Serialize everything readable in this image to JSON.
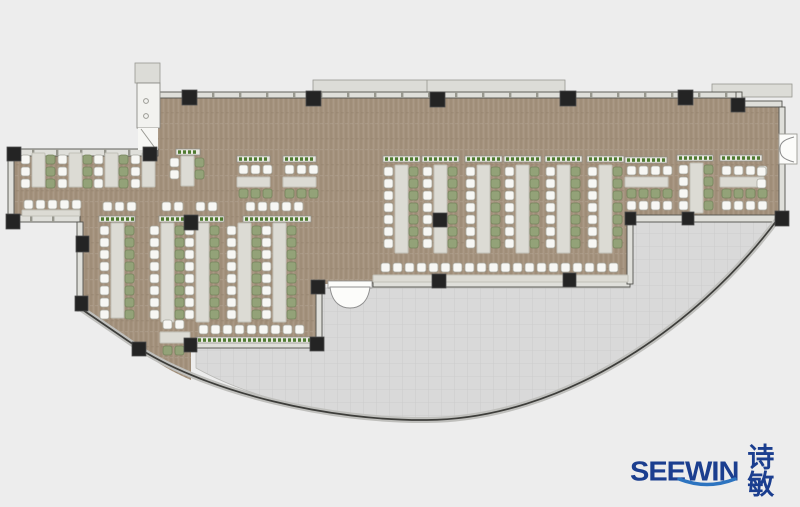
{
  "canvas": {
    "w": 800,
    "h": 507,
    "bg": "#ededed"
  },
  "colors": {
    "floor_wood": "#a5937e",
    "floor_tile": "#d9d9d9",
    "tile_line": "#c9c9c9",
    "wall_fill": "#dfdfda",
    "wall_line": "#52524d",
    "ledge_fill": "#dcdcd7",
    "ledge_line": "#97978f",
    "facade_band": "#bfbfbc",
    "facade_line": "#3d3d3a",
    "column": "#242424",
    "desk_fill": "#dcdbd4",
    "desk_line": "#c2c1b8",
    "chair_white": "#f7f7f4",
    "chair_white_line": "#a8a89e",
    "chair_green": "#93a278",
    "chair_green_line": "#75845c",
    "planter_fill": "#e9e8e1",
    "planter_line": "#8e8e86",
    "planter_green": "#4e7a30",
    "door_fill": "#fcfcfa",
    "door_line": "#8e8e8e",
    "logo_navy": "#1b3e8f",
    "logo_smile": "#2d74c0"
  },
  "logo": {
    "brand": "SEEWIN",
    "cn": "诗敏"
  },
  "floors": {
    "brown": "M158,92 L740,92 L740,104 L782,104 L782,215 L630,215 L630,284 L322,284 L322,345 L191,345 L191,380 C163,368 148,356 140,349 L80,308 L80,222 L11,222 L11,152 L158,152 Z",
    "gray": "M196,348 L322,348 L322,288 L630,288 L630,222 L773,222 C688,332 560,418 427,419 C333,419 252,399 196,368 Z"
  },
  "facade": {
    "path": "M80,308 L140,349 C210,393 330,421 427,420 C560,419 695,330 777,220"
  },
  "ledges": [
    {
      "x": 313,
      "y": 80,
      "w": 252,
      "h": 13,
      "div": 427
    },
    {
      "x": 712,
      "y": 84,
      "w": 80,
      "h": 13
    },
    {
      "x": 135,
      "y": 63,
      "w": 25,
      "h": 20
    }
  ],
  "walls": [
    {
      "x": 158,
      "y": 92,
      "w": 582,
      "h": 6,
      "ticks": 27
    },
    {
      "x": 736,
      "y": 92,
      "w": 6,
      "h": 12
    },
    {
      "x": 736,
      "y": 101,
      "w": 46,
      "h": 6
    },
    {
      "x": 779,
      "y": 107,
      "w": 6,
      "h": 29
    },
    {
      "x": 779,
      "y": 163,
      "w": 6,
      "h": 52
    },
    {
      "x": 8,
      "y": 149,
      "w": 150,
      "h": 7,
      "ticks": 24
    },
    {
      "x": 8,
      "y": 149,
      "w": 6,
      "h": 72
    },
    {
      "x": 8,
      "y": 215,
      "w": 72,
      "h": 7,
      "ticks": 22
    },
    {
      "x": 77,
      "y": 222,
      "w": 6,
      "h": 89
    },
    {
      "x": 188,
      "y": 342,
      "w": 134,
      "h": 6
    },
    {
      "x": 316,
      "y": 286,
      "w": 6,
      "h": 60
    },
    {
      "x": 373,
      "y": 281,
      "w": 257,
      "h": 6
    },
    {
      "x": 627,
      "y": 222,
      "w": 6,
      "h": 62
    },
    {
      "x": 627,
      "y": 215,
      "w": 154,
      "h": 7
    }
  ],
  "shaft": {
    "x": 137,
    "y": 83,
    "w": 23,
    "h": 45,
    "dots": [
      [
        146,
        101
      ],
      [
        146,
        116
      ]
    ],
    "door": {
      "x": 138,
      "y": 128,
      "w": 20,
      "h": 22
    }
  },
  "doors": {
    "entrance": {
      "sill": [
        328,
        281,
        44,
        7
      ],
      "leaf": "M330,287 C332,303 341,308 350,308 C359,308 368,303 370,287 Z"
    },
    "side": {
      "box": [
        779,
        134,
        18,
        30
      ],
      "arcs": "M794,137 C782,140 780,144 780,149 M794,162 C782,159 780,155 780,149"
    }
  },
  "columns": [
    [
      182,
      90,
      15,
      15
    ],
    [
      306,
      91,
      15,
      15
    ],
    [
      430,
      92,
      15,
      15
    ],
    [
      560,
      91,
      16,
      15
    ],
    [
      678,
      90,
      15,
      15
    ],
    [
      731,
      98,
      14,
      14
    ],
    [
      775,
      211,
      14,
      15
    ],
    [
      7,
      147,
      14,
      14
    ],
    [
      143,
      147,
      14,
      14
    ],
    [
      6,
      214,
      14,
      15
    ],
    [
      76,
      236,
      13,
      16
    ],
    [
      75,
      296,
      13,
      15
    ],
    [
      132,
      342,
      14,
      14
    ],
    [
      184,
      338,
      13,
      14
    ],
    [
      311,
      280,
      14,
      14
    ],
    [
      310,
      337,
      14,
      14
    ],
    [
      433,
      213,
      14,
      14
    ],
    [
      184,
      215,
      14,
      15
    ],
    [
      432,
      274,
      14,
      14
    ],
    [
      563,
      273,
      13,
      14
    ],
    [
      682,
      212,
      12,
      13
    ],
    [
      625,
      212,
      11,
      13
    ]
  ],
  "furniture": [
    {
      "t": "vdesk",
      "x": 32,
      "y": 153,
      "h": 34
    },
    {
      "t": "cv",
      "x": 21,
      "y": 155,
      "n": 3,
      "c": "w"
    },
    {
      "t": "cv",
      "x": 46,
      "y": 155,
      "n": 3,
      "c": "g"
    },
    {
      "t": "vdesk",
      "x": 69,
      "y": 153,
      "h": 34
    },
    {
      "t": "cv",
      "x": 58,
      "y": 155,
      "n": 3,
      "c": "w"
    },
    {
      "t": "cv",
      "x": 83,
      "y": 155,
      "n": 3,
      "c": "g"
    },
    {
      "t": "vdesk",
      "x": 105,
      "y": 153,
      "h": 34
    },
    {
      "t": "cv",
      "x": 94,
      "y": 155,
      "n": 3,
      "c": "w"
    },
    {
      "t": "cv",
      "x": 119,
      "y": 155,
      "n": 3,
      "c": "g"
    },
    {
      "t": "vdesk",
      "x": 142,
      "y": 153,
      "h": 34
    },
    {
      "t": "cv",
      "x": 131,
      "y": 155,
      "n": 3,
      "c": "w"
    },
    {
      "t": "ch",
      "x": 24,
      "y": 200,
      "n": 5,
      "c": "w"
    },
    {
      "t": "hdesk",
      "x": 22,
      "y": 210,
      "w": 58,
      "h": 6
    },
    {
      "t": "planter",
      "x": 176,
      "y": 149,
      "w": 24
    },
    {
      "t": "vdesk",
      "x": 181,
      "y": 156,
      "h": 30
    },
    {
      "t": "cv",
      "x": 170,
      "y": 158,
      "n": 2,
      "c": "w"
    },
    {
      "t": "cv",
      "x": 195,
      "y": 158,
      "n": 2,
      "c": "g"
    },
    {
      "t": "ch",
      "x": 103,
      "y": 202,
      "n": 3,
      "c": "w"
    },
    {
      "t": "ch",
      "x": 162,
      "y": 202,
      "n": 2,
      "c": "w"
    },
    {
      "t": "ch",
      "x": 196,
      "y": 202,
      "n": 2,
      "c": "w"
    },
    {
      "t": "ch",
      "x": 246,
      "y": 202,
      "n": 5,
      "c": "w"
    },
    {
      "t": "planter",
      "x": 99,
      "y": 216,
      "w": 36
    },
    {
      "t": "planter",
      "x": 159,
      "y": 216,
      "w": 31
    },
    {
      "t": "planter",
      "x": 193,
      "y": 216,
      "w": 31
    },
    {
      "t": "planter",
      "x": 243,
      "y": 216,
      "w": 68
    },
    {
      "t": "vdesk",
      "x": 111,
      "y": 223,
      "h": 95
    },
    {
      "t": "cv",
      "x": 100,
      "y": 226,
      "n": 8,
      "c": "w"
    },
    {
      "t": "cv",
      "x": 125,
      "y": 226,
      "n": 8,
      "c": "g"
    },
    {
      "t": "vdesk",
      "x": 161,
      "y": 223,
      "h": 99
    },
    {
      "t": "cv",
      "x": 150,
      "y": 226,
      "n": 8,
      "c": "w"
    },
    {
      "t": "cv",
      "x": 175,
      "y": 226,
      "n": 8,
      "c": "g"
    },
    {
      "t": "vdesk",
      "x": 196,
      "y": 223,
      "h": 99
    },
    {
      "t": "cv",
      "x": 185,
      "y": 226,
      "n": 8,
      "c": "w"
    },
    {
      "t": "cv",
      "x": 210,
      "y": 226,
      "n": 8,
      "c": "g"
    },
    {
      "t": "vdesk",
      "x": 238,
      "y": 223,
      "h": 99
    },
    {
      "t": "cv",
      "x": 227,
      "y": 226,
      "n": 8,
      "c": "w"
    },
    {
      "t": "cv",
      "x": 252,
      "y": 226,
      "n": 8,
      "c": "g"
    },
    {
      "t": "vdesk",
      "x": 273,
      "y": 223,
      "h": 99
    },
    {
      "t": "cv",
      "x": 262,
      "y": 226,
      "n": 8,
      "c": "w"
    },
    {
      "t": "cv",
      "x": 287,
      "y": 226,
      "n": 8,
      "c": "g"
    },
    {
      "t": "ch",
      "x": 199,
      "y": 325,
      "n": 9,
      "c": "w"
    },
    {
      "t": "planter",
      "x": 196,
      "y": 337,
      "w": 118
    },
    {
      "t": "ch",
      "x": 163,
      "y": 320,
      "n": 2,
      "c": "w"
    },
    {
      "t": "hdesk",
      "x": 160,
      "y": 332,
      "w": 30,
      "h": 11
    },
    {
      "t": "ch",
      "x": 163,
      "y": 346,
      "n": 2,
      "c": "g"
    },
    {
      "t": "planter",
      "x": 237,
      "y": 156,
      "w": 33
    },
    {
      "t": "ch",
      "x": 239,
      "y": 165,
      "n": 3,
      "c": "w"
    },
    {
      "t": "hdesk",
      "x": 237,
      "y": 177,
      "w": 33,
      "h": 10
    },
    {
      "t": "ch",
      "x": 239,
      "y": 189,
      "n": 3,
      "c": "g"
    },
    {
      "t": "planter",
      "x": 283,
      "y": 156,
      "w": 33
    },
    {
      "t": "ch",
      "x": 285,
      "y": 165,
      "n": 3,
      "c": "w"
    },
    {
      "t": "hdesk",
      "x": 283,
      "y": 177,
      "w": 33,
      "h": 10
    },
    {
      "t": "ch",
      "x": 285,
      "y": 189,
      "n": 3,
      "c": "g"
    },
    {
      "t": "planter",
      "x": 383,
      "y": 156,
      "w": 37
    },
    {
      "t": "vdesk",
      "x": 395,
      "y": 165,
      "h": 88
    },
    {
      "t": "cv",
      "x": 384,
      "y": 167,
      "n": 7,
      "c": "w"
    },
    {
      "t": "cv",
      "x": 409,
      "y": 167,
      "n": 7,
      "c": "g"
    },
    {
      "t": "planter",
      "x": 422,
      "y": 156,
      "w": 37
    },
    {
      "t": "vdesk",
      "x": 434,
      "y": 165,
      "h": 88
    },
    {
      "t": "cv",
      "x": 423,
      "y": 167,
      "n": 7,
      "c": "w"
    },
    {
      "t": "cv",
      "x": 448,
      "y": 167,
      "n": 7,
      "c": "g"
    },
    {
      "t": "planter",
      "x": 465,
      "y": 156,
      "w": 37
    },
    {
      "t": "vdesk",
      "x": 477,
      "y": 165,
      "h": 88
    },
    {
      "t": "cv",
      "x": 466,
      "y": 167,
      "n": 7,
      "c": "w"
    },
    {
      "t": "cv",
      "x": 491,
      "y": 167,
      "n": 7,
      "c": "g"
    },
    {
      "t": "planter",
      "x": 504,
      "y": 156,
      "w": 37
    },
    {
      "t": "vdesk",
      "x": 516,
      "y": 165,
      "h": 88
    },
    {
      "t": "cv",
      "x": 505,
      "y": 167,
      "n": 7,
      "c": "w"
    },
    {
      "t": "cv",
      "x": 530,
      "y": 167,
      "n": 7,
      "c": "g"
    },
    {
      "t": "planter",
      "x": 545,
      "y": 156,
      "w": 37
    },
    {
      "t": "vdesk",
      "x": 557,
      "y": 165,
      "h": 88
    },
    {
      "t": "cv",
      "x": 546,
      "y": 167,
      "n": 7,
      "c": "w"
    },
    {
      "t": "cv",
      "x": 571,
      "y": 167,
      "n": 7,
      "c": "g"
    },
    {
      "t": "planter",
      "x": 587,
      "y": 156,
      "w": 37
    },
    {
      "t": "vdesk",
      "x": 599,
      "y": 165,
      "h": 88
    },
    {
      "t": "cv",
      "x": 588,
      "y": 167,
      "n": 7,
      "c": "w"
    },
    {
      "t": "cv",
      "x": 613,
      "y": 167,
      "n": 7,
      "c": "g"
    },
    {
      "t": "ch",
      "x": 381,
      "y": 263,
      "n": 20,
      "c": "w"
    },
    {
      "t": "hdesk",
      "x": 373,
      "y": 275,
      "w": 255,
      "h": 7
    },
    {
      "t": "planter",
      "x": 625,
      "y": 157,
      "w": 42
    },
    {
      "t": "ch",
      "x": 627,
      "y": 166,
      "n": 4,
      "c": "w"
    },
    {
      "t": "hdesk",
      "x": 625,
      "y": 177,
      "w": 43,
      "h": 10
    },
    {
      "t": "ch",
      "x": 627,
      "y": 189,
      "n": 4,
      "c": "g"
    },
    {
      "t": "ch",
      "x": 627,
      "y": 201,
      "n": 4,
      "c": "w"
    },
    {
      "t": "planter",
      "x": 677,
      "y": 155,
      "w": 36
    },
    {
      "t": "vdesk",
      "x": 690,
      "y": 163,
      "h": 50
    },
    {
      "t": "cv",
      "x": 679,
      "y": 165,
      "n": 4,
      "c": "w"
    },
    {
      "t": "cv",
      "x": 704,
      "y": 165,
      "n": 4,
      "c": "g"
    },
    {
      "t": "planter",
      "x": 720,
      "y": 155,
      "w": 42
    },
    {
      "t": "ch",
      "x": 722,
      "y": 166,
      "n": 4,
      "c": "w"
    },
    {
      "t": "hdesk",
      "x": 720,
      "y": 177,
      "w": 44,
      "h": 10
    },
    {
      "t": "ch",
      "x": 722,
      "y": 189,
      "n": 4,
      "c": "g"
    },
    {
      "t": "ch",
      "x": 722,
      "y": 201,
      "n": 4,
      "c": "w"
    },
    {
      "t": "cv",
      "x": 757,
      "y": 167,
      "n": 2,
      "c": "w"
    }
  ]
}
